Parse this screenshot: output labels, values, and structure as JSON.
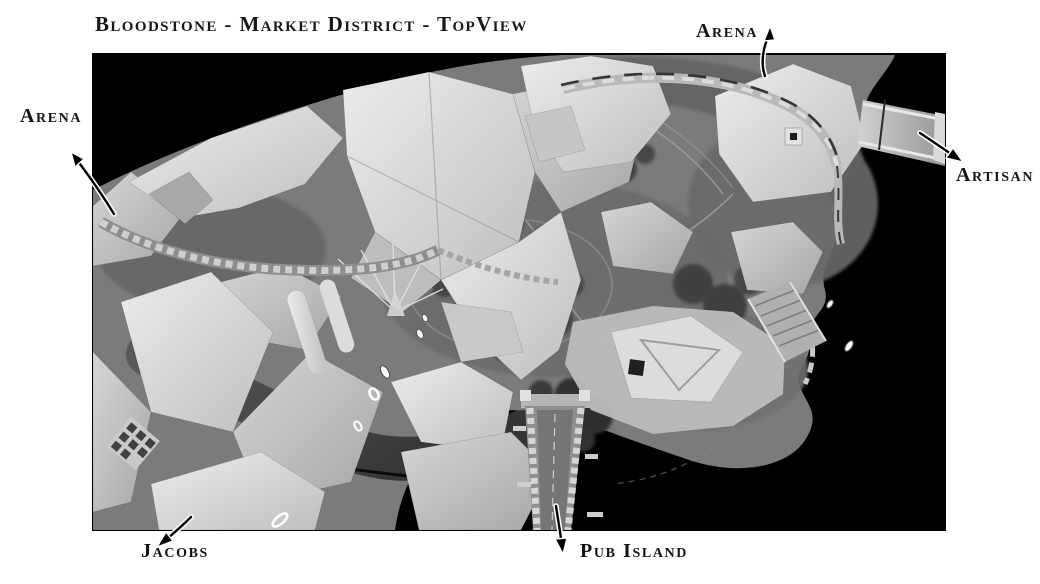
{
  "title": "Bloodstone - Market District - TopView",
  "labels": {
    "arena_top": "Arena",
    "arena_left": "Arena",
    "artisan": "Artisan",
    "jacobs": "Jacobs",
    "pub_island": "Pub Island"
  },
  "map": {
    "description": "Grayscale top-down 3D render of the Bloodstone Market District: clustered market roofs, a central domed plaza ringed by trees, a crenellated city wall, a long bridge to Pub Island and a small bridge toward the Artisan quarter.",
    "colors": {
      "page_background": "#ffffff",
      "void": "#000000",
      "terrain": "#7b7b7b",
      "plaza": "#6c6c6c",
      "roofs": "#d9d9d9",
      "foliage": "#454545",
      "walls": "#c4c4c4",
      "ink": "#1a1a1a"
    }
  }
}
